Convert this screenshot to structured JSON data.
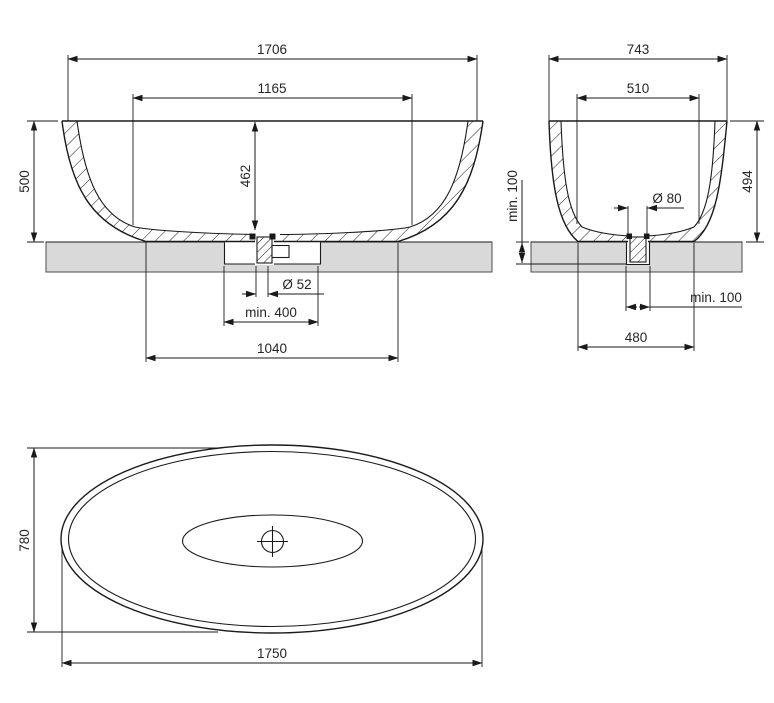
{
  "drawing": {
    "type": "bathtub-technical-drawing",
    "views": {
      "front": {
        "dims": {
          "overall_width": "1706",
          "interior_width": "1165",
          "height": "500",
          "interior_depth": "462",
          "drain_diameter": "Ø 52",
          "recess_min_width": "min. 400",
          "footprint_width": "1040"
        }
      },
      "side": {
        "dims": {
          "overall_width": "743",
          "interior_width": "510",
          "height": "494",
          "recess_min_depth": "min. 100",
          "drain_diameter": "Ø 80",
          "recess_min_width": "min. 100",
          "footprint_width": "480"
        }
      },
      "top": {
        "dims": {
          "overall_depth": "780",
          "overall_length": "1750"
        }
      }
    },
    "colors": {
      "line": "#1a1a1a",
      "floor_fill": "#d9d9d9",
      "background": "#ffffff",
      "text": "#262626"
    }
  }
}
